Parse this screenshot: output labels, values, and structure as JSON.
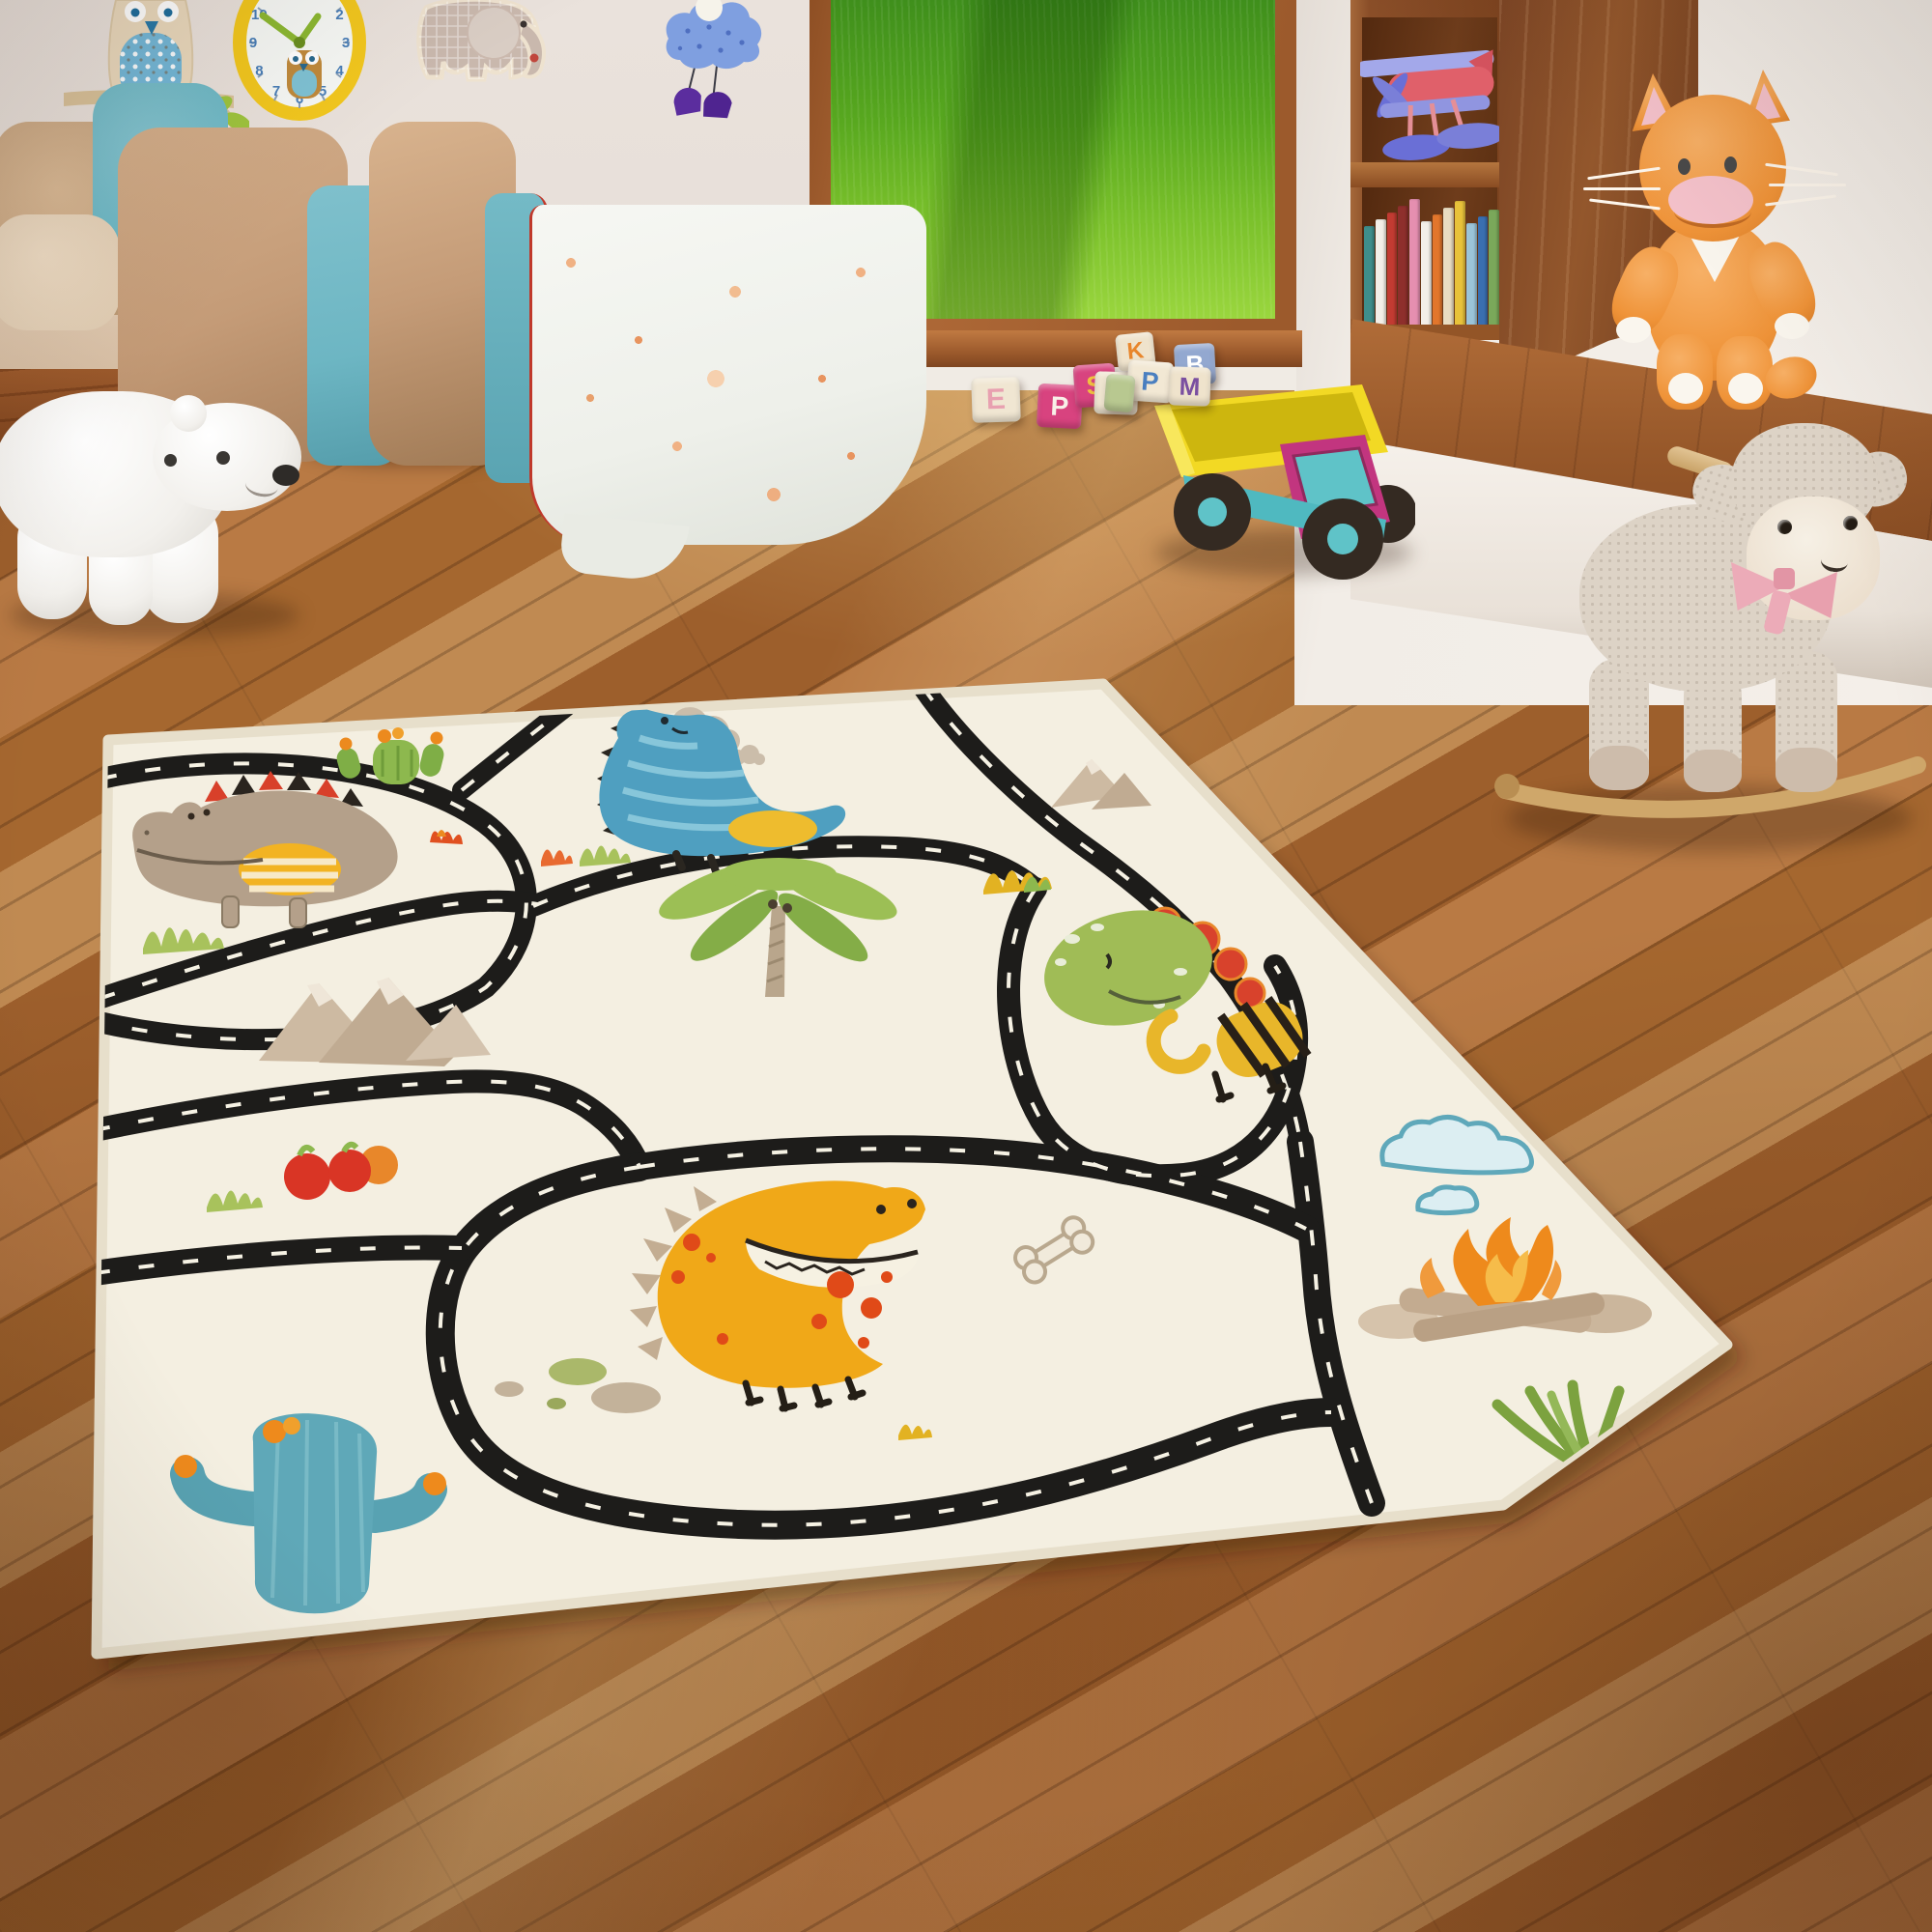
{
  "scene": {
    "description": "Sunlit children's playroom with a cream dinosaur road play rug on a wooden plank floor, pastel bed with wall decals, open doorway to a green lawn, bookshelf with toy seaplane, and plush toys",
    "room_type": "kids bedroom / playroom"
  },
  "palette": {
    "wall_left": "#e9e1db",
    "wall_right": "#f2ede7",
    "floor_mid": "#b0743d",
    "floor_dark": "#8a4f26",
    "floor_light": "#c98f55",
    "rug_base": "#f4efe1",
    "road_black": "#1d1c1a",
    "road_dash": "#f6f2e4",
    "lawn_green": "#6fae2a",
    "wood_frame": "#a05a2e"
  },
  "window": {
    "view": "sunlit green lawn",
    "frame_color": "#a05a2e"
  },
  "clock": {
    "frame_color": "#f2c71e",
    "hand_color": "#8cb832",
    "face_color": "#f6f8f5",
    "numbers": [
      "1",
      "2",
      "3",
      "4",
      "5",
      "6",
      "7",
      "8",
      "9",
      "10",
      "11",
      "12"
    ]
  },
  "wall_decor": {
    "owl_decal": "cream owl with blue dotted belly perched on a branch",
    "elephant_decal": "beige plaid elephant",
    "cloud_mobile": "blue cloud with hanging purple boots"
  },
  "bed": {
    "pillow_tan": "#c9a783",
    "pillow_teal": "#6fb9c6",
    "blanket_tan": "#c49b77",
    "blanket_teal": "#6db6c3",
    "duvet": "white with orange floral print",
    "accent_piping": "#c0392b"
  },
  "bookshelf": {
    "wood_color": "#8a4e28",
    "toy": "wooden seaplane in red and periwinkle",
    "book_colors": [
      "#3f8e8b",
      "#f3efe8",
      "#c23b32",
      "#8e2f2c",
      "#e58fb0",
      "#f3efe8",
      "#e2762c",
      "#e9ddc2",
      "#e8c23a",
      "#9bc4d8",
      "#3a6fb0",
      "#7aa85a"
    ]
  },
  "toys": {
    "polar_bear": {
      "color": "#ffffff",
      "pose": "walking beside the bed"
    },
    "dump_truck": {
      "tipper": "#f2d924",
      "cab": "#c2357f",
      "chassis": "#4fb9c0",
      "wheel": "#342a22",
      "hub": "#5fc3c8"
    },
    "plush_cat": {
      "color": "#f09a3e",
      "bib": "#faf6ee",
      "ears_inner": "#f5c2cb",
      "spot": "sitting on wooden bench"
    },
    "rocking_sheep": {
      "fleece": "#ddd3c6",
      "face": "#f2ebdf",
      "bow": "#ecabb8",
      "rocker_wood": "#cfa76a"
    },
    "blocks": [
      {
        "letter": "E",
        "block_color": "#f0e6d2",
        "letter_color": "#e8a0b0"
      },
      {
        "letter": "P",
        "block_color": "#d8437f",
        "letter_color": "#f8f0e8"
      },
      {
        "letter": "S",
        "block_color": "#d8437f",
        "letter_color": "#f0c040"
      },
      {
        "letter": "V",
        "block_color": "#efe5d0",
        "letter_color": "#e8b43c"
      },
      {
        "letter": "K",
        "block_color": "#efe3cc",
        "letter_color": "#e8862c"
      },
      {
        "letter": "P",
        "block_color": "#f2e8d4",
        "letter_color": "#4a7fc0"
      },
      {
        "letter": "B",
        "block_color": "#93a8d0",
        "letter_color": "#ffffff"
      },
      {
        "letter": "M",
        "block_color": "#efe3cc",
        "letter_color": "#7a4fa0"
      },
      {
        "letter": "",
        "block_color": "#b8c890",
        "letter_color": "#ffffff"
      }
    ]
  },
  "rug": {
    "theme": "dinosaur road play rug",
    "base_color": "#f4efe1",
    "elements": [
      "crocodile dino",
      "green cactus",
      "blue dino",
      "gray clouds",
      "palm tree",
      "mountains",
      "berries",
      "green dino",
      "yellow dino",
      "bone",
      "blue clouds",
      "campfire",
      "teal cactus",
      "fern",
      "grass tufts",
      "pebbles"
    ],
    "dino_colors": {
      "crocodile": "#b4a08a",
      "blue": "#4f9fc0",
      "green": "#a0bc56",
      "yellow": "#f0a818"
    }
  }
}
